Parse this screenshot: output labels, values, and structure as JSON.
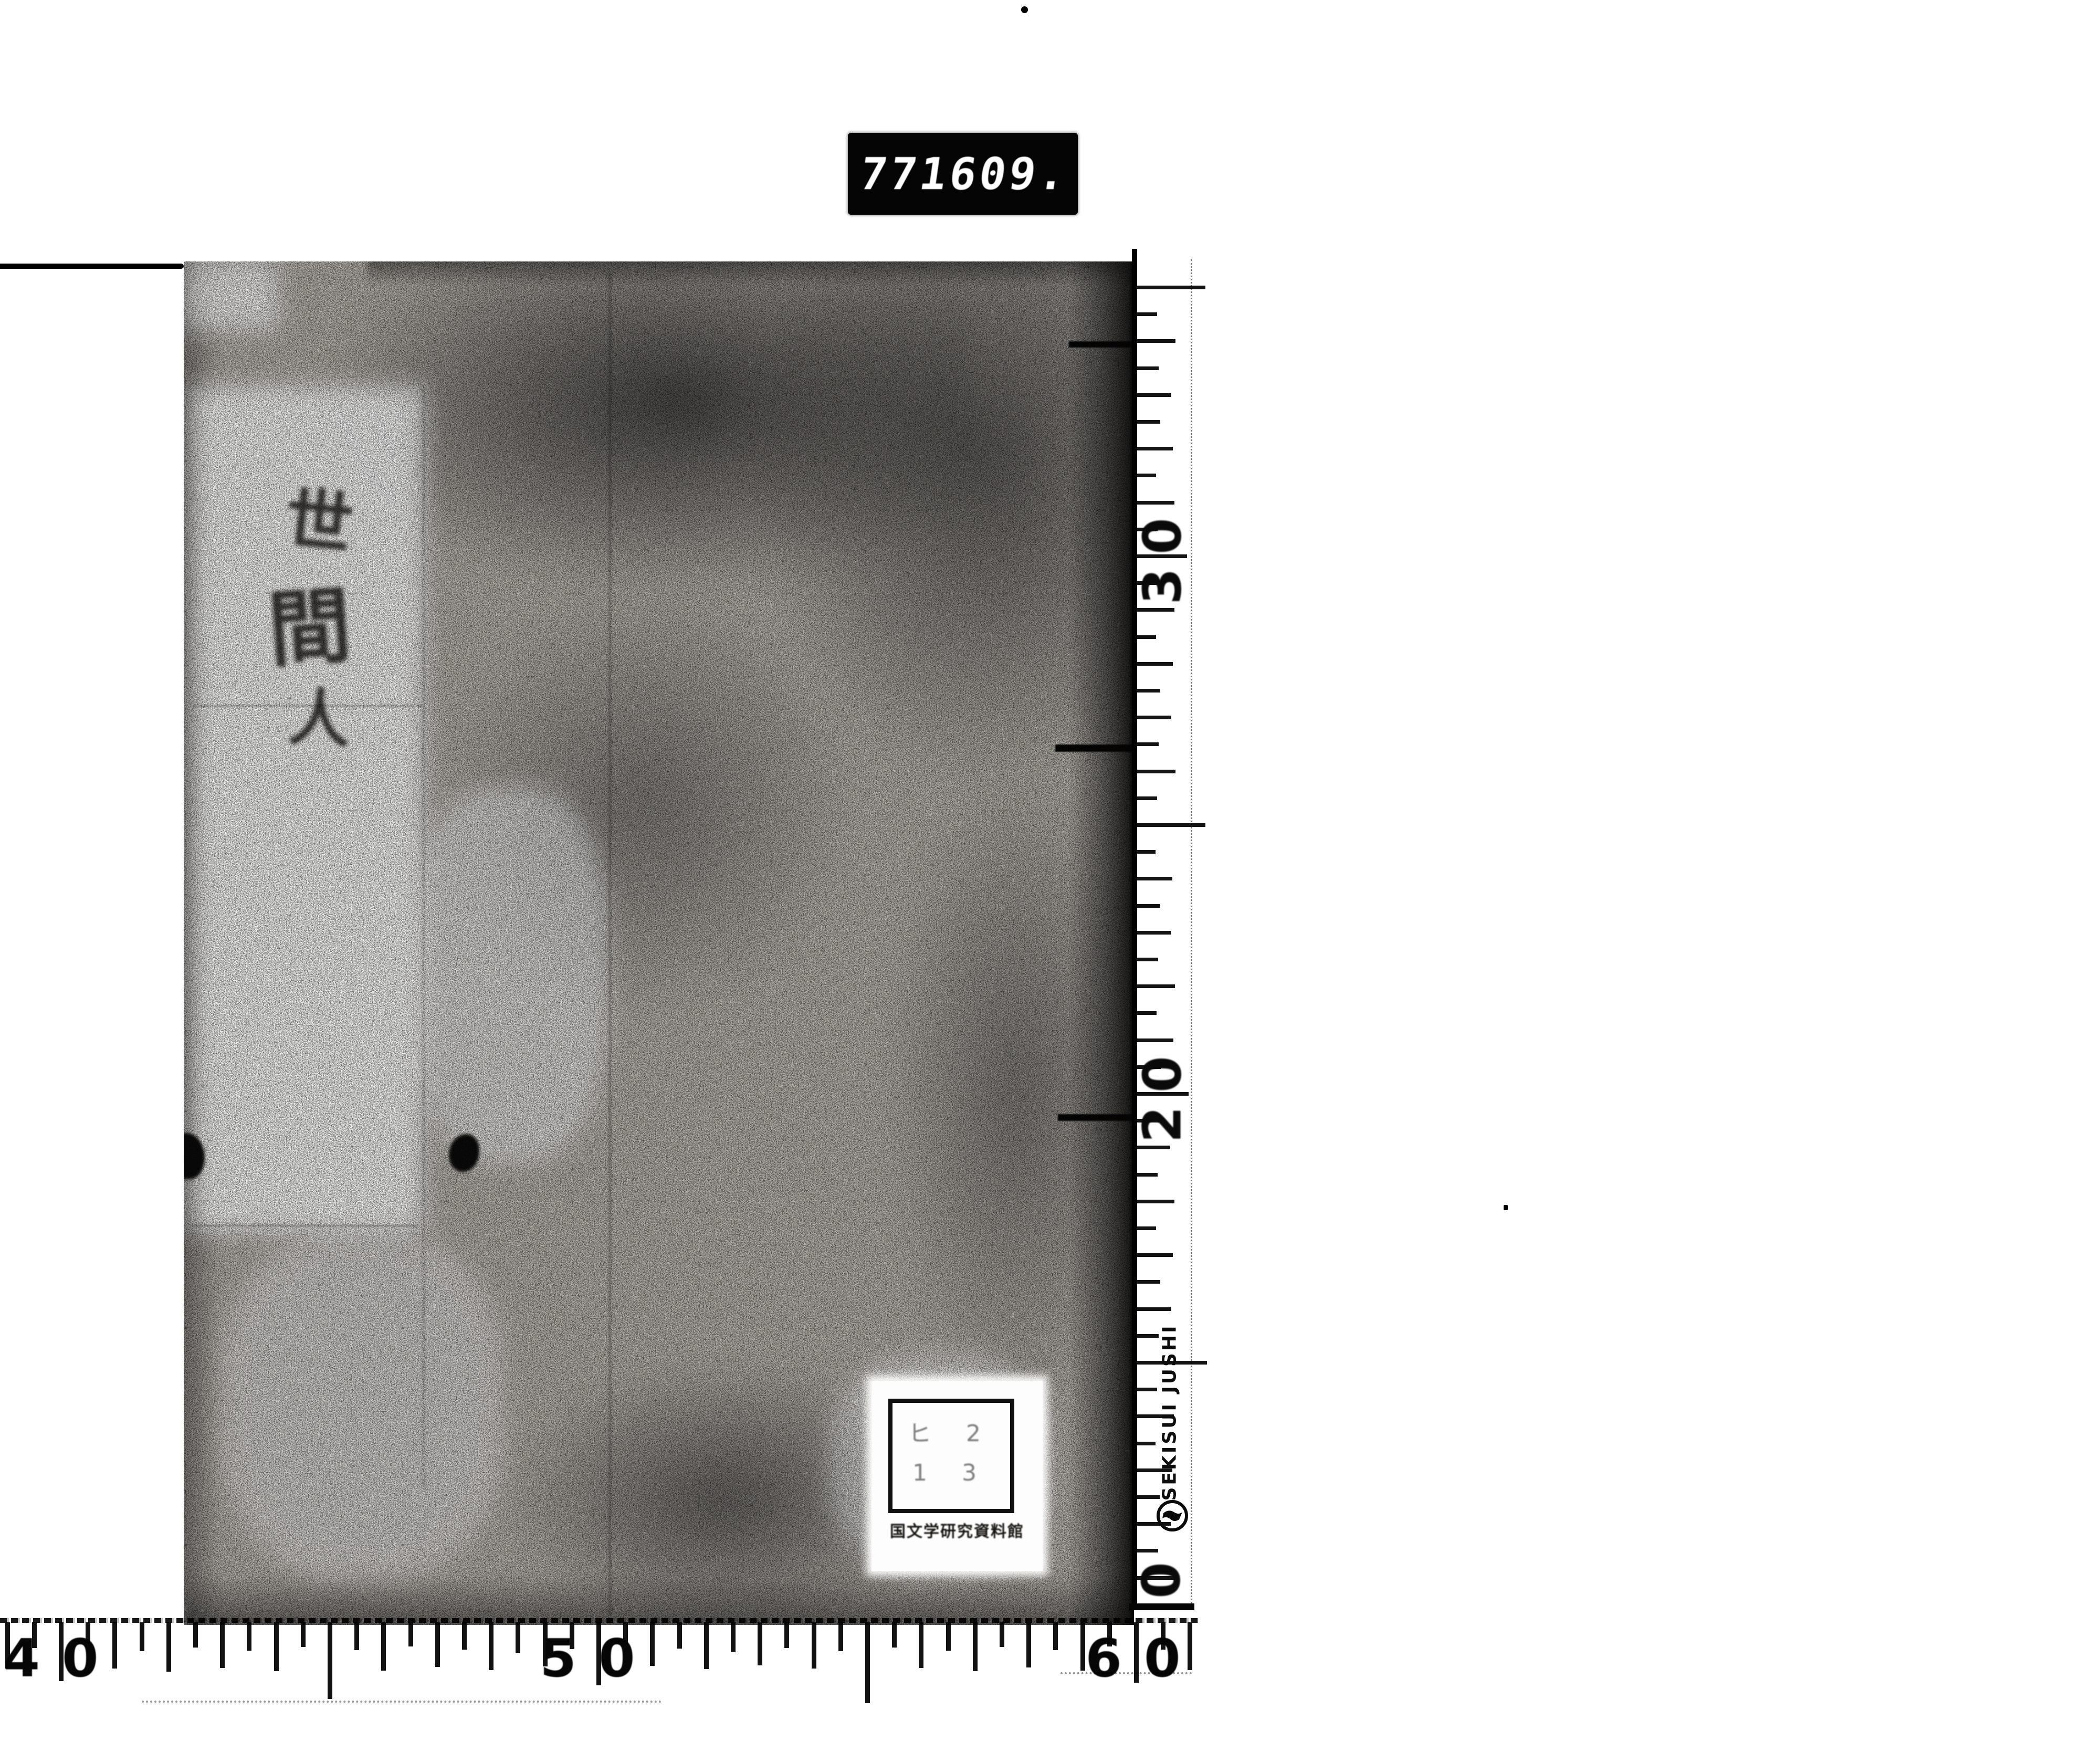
{
  "counter": {
    "group1": "771",
    "group2": "609."
  },
  "book": {
    "calligraphy_chars": [
      "世",
      "間",
      "人"
    ],
    "label": {
      "line1": "ヒ 2",
      "line2": "1 3",
      "caption": "国文学研究資料館"
    }
  },
  "vertical_ruler": {
    "unit_labels": [
      "30",
      "20",
      "0"
    ],
    "brand": "SEKISUI JUSHI"
  },
  "bottom_ruler": {
    "unit_labels": [
      "40",
      "50",
      "60"
    ]
  }
}
